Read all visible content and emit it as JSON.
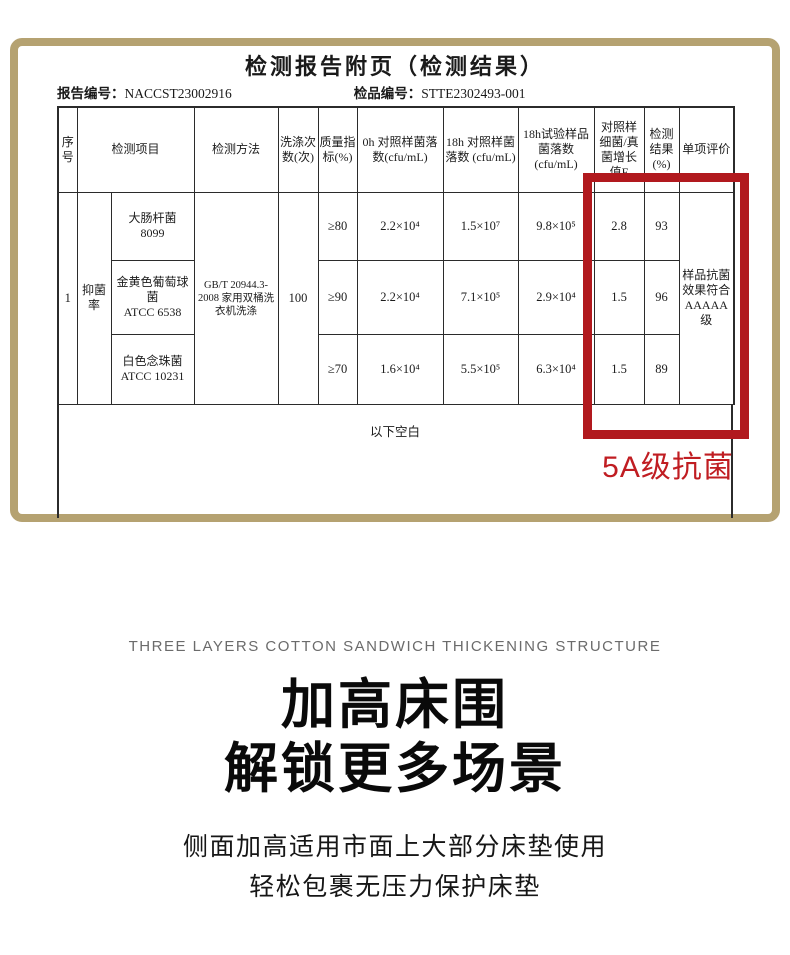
{
  "report": {
    "title": "检测报告附页（检测结果）",
    "report_no_label": "报告编号：",
    "report_no": "NACCST23002916",
    "sample_no_label": "检品编号：",
    "sample_no": "STTE2302493-001",
    "border_color": "#b5a271",
    "highlight": {
      "label": "5A级抗菌",
      "color": "#b1191e"
    },
    "table": {
      "headers": {
        "serial": "序号",
        "item": "检测项目",
        "method": "检测方法",
        "wash_count": "洗涤次数(次)",
        "quality_index": "质量指标(%)",
        "cfu_0h": "0h 对照样菌落数(cfu/mL)",
        "cfu_18h_control": "18h 对照样菌落数 (cfu/mL)",
        "cfu_18h_sample": "18h试验样品菌落数 (cfu/mL)",
        "growth_value": "对照样细菌/真菌增长值F",
        "result": "检测结果(%)",
        "evaluation": "单项评价"
      },
      "serial": "1",
      "item_group": "抑菌率",
      "method": "GB/T 20944.3-2008 家用双桶洗衣机洗涤",
      "wash_count": "100",
      "evaluation": "样品抗菌效果符合AAAAA级",
      "rows": [
        {
          "organism": "大肠杆菌",
          "strain": "8099",
          "quality_index": "≥80",
          "cfu_0h": "2.2×10⁴",
          "cfu_18h_control": "1.5×10⁷",
          "cfu_18h_sample": "9.8×10⁵",
          "growth_value": "2.8",
          "result": "93"
        },
        {
          "organism": "金黄色葡萄球菌",
          "strain": "ATCC 6538",
          "quality_index": "≥90",
          "cfu_0h": "2.2×10⁴",
          "cfu_18h_control": "7.1×10⁵",
          "cfu_18h_sample": "2.9×10⁴",
          "growth_value": "1.5",
          "result": "96"
        },
        {
          "organism": "白色念珠菌",
          "strain": "ATCC 10231",
          "quality_index": "≥70",
          "cfu_0h": "1.6×10⁴",
          "cfu_18h_control": "5.5×10⁵",
          "cfu_18h_sample": "6.3×10⁴",
          "growth_value": "1.5",
          "result": "89"
        }
      ],
      "blank_note": "以下空白"
    }
  },
  "feature": {
    "eyebrow": "THREE LAYERS COTTON SANDWICH THICKENING STRUCTURE",
    "heading_line1": "加高床围",
    "heading_line2": "解锁更多场景",
    "sub_line1": "侧面加高适用市面上大部分床垫使用",
    "sub_line2": "轻松包裹无压力保护床垫"
  }
}
